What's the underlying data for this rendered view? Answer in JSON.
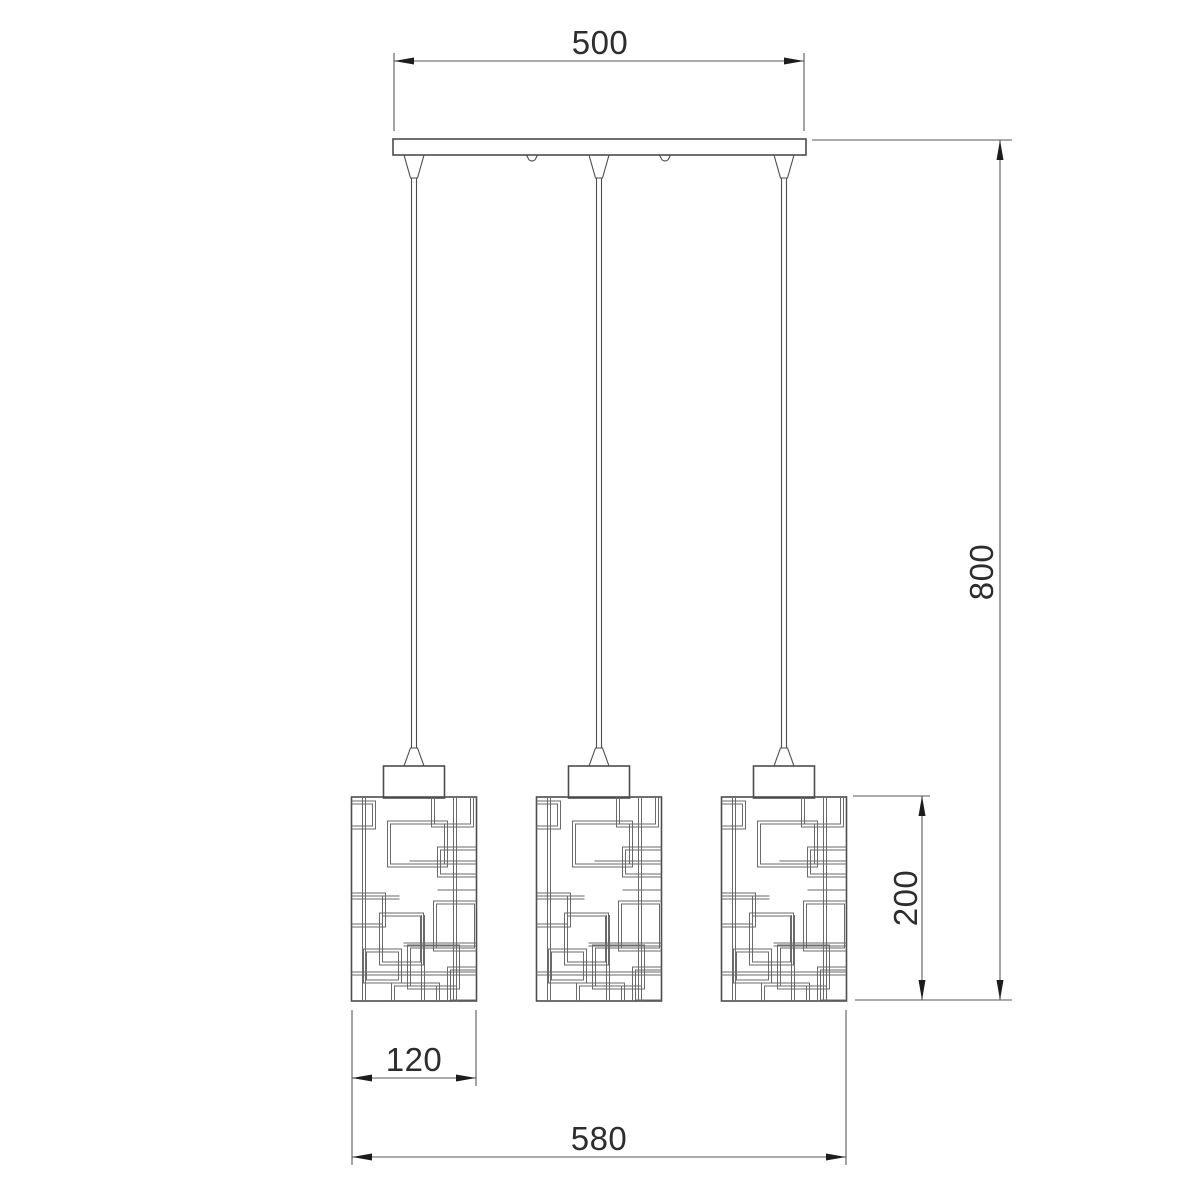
{
  "drawing": {
    "kind": "technical dimension drawing, 3-shade linear pendant lamp",
    "units_implied": "mm",
    "dimensions": {
      "canopy_width": "500",
      "drop_height": "800",
      "shade_height": "200",
      "shade_width": "120",
      "overall_width": "580"
    },
    "colors": {
      "background": "#ffffff",
      "object_line": "#4d4d4d",
      "pattern_line": "#6a6a6a",
      "dimension_line": "#595959",
      "arrow": "#1c1c1c",
      "text": "#2d2d2d"
    }
  }
}
